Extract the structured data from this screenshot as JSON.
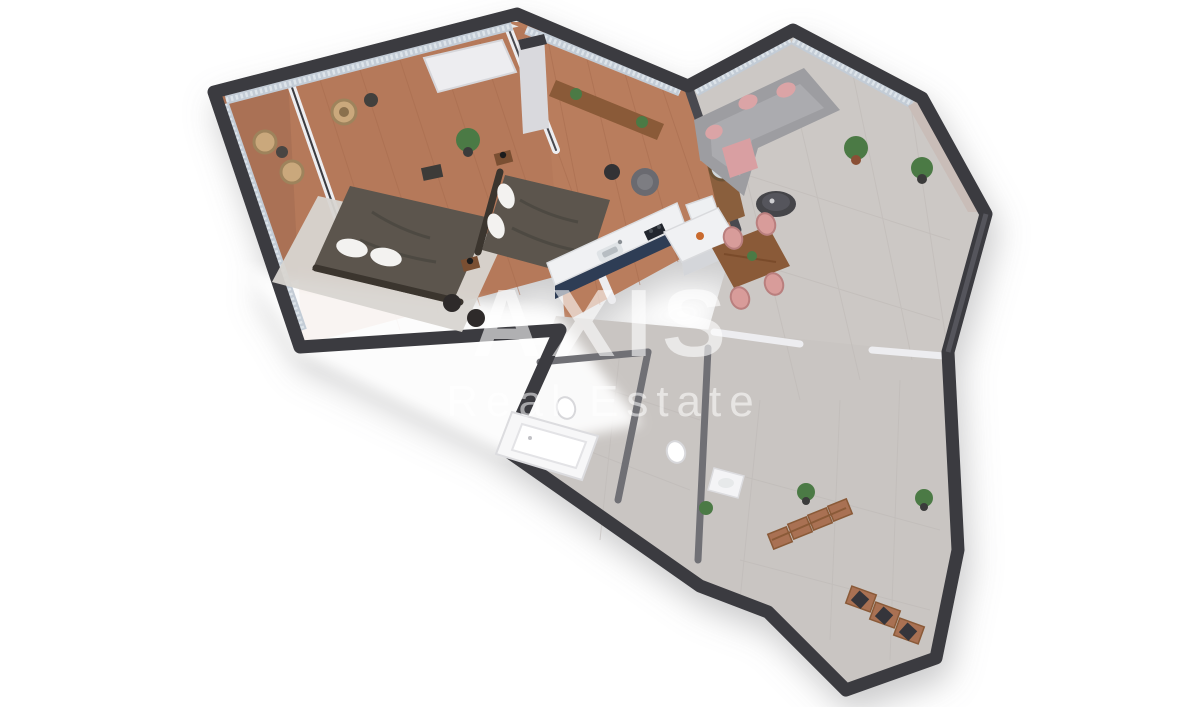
{
  "scene": {
    "type": "isometric-3d-floor-plan-render",
    "background": "#ffffff",
    "description": "3D cutaway floor plan of a two-bedroom apartment viewed from above at an angle"
  },
  "watermark": {
    "line1": "AXIS",
    "line2": "Real Estate",
    "color": "#ffffff"
  },
  "palette": {
    "wall_dark": "#3b3b40",
    "wall_mid": "#6f6f75",
    "wall_light": "#ededf0",
    "wood_floor": "#b5795a",
    "wood_floor_line": "#a76c4e",
    "tile_floor": "#ccc8c5",
    "tile_line": "#bfbab7",
    "blinds": "#c3ccd6",
    "blind_slat": "#dde4ea",
    "bedding_dark": "#5b554d",
    "rug": "#d8d5d1",
    "sofa_gray": "#9d9da1",
    "accent_pink": "#dba4a6",
    "kitchen_navy": "#2f3c54",
    "counter_white": "#f0f1f3",
    "wood_furniture": "#a97152",
    "wood_dark": "#8a5a38",
    "plant_green": "#4c7a45",
    "fixture_white": "#f7f7f8",
    "cushion_dark": "#35353a"
  },
  "rooms": [
    {
      "name": "balcony",
      "floor": "wood",
      "furniture": [
        "wicker-chair",
        "wicker-chair",
        "side-table"
      ]
    },
    {
      "name": "bedroom-1",
      "floor": "wood",
      "furniture": [
        "double-bed",
        "rug",
        "headboard",
        "stool",
        "stool",
        "rattan-chair",
        "side-table",
        "wardrobe",
        "dresser"
      ]
    },
    {
      "name": "bedroom-2",
      "floor": "wood",
      "furniture": [
        "double-bed",
        "nightstand",
        "nightstand",
        "window-bench",
        "barrel-chair",
        "side-table",
        "plant",
        "white-column"
      ]
    },
    {
      "name": "kitchen",
      "floor": "tile",
      "furniture": [
        "navy-counter",
        "sink",
        "cooktop",
        "tall-cabinet"
      ]
    },
    {
      "name": "living-dining",
      "floor": "tile",
      "furniture": [
        "corner-sofa",
        "pink-pillows",
        "pink-throw",
        "coffee-table",
        "media-partition-round-mirror",
        "kitchen-island",
        "dining-table",
        "dining-chairs-x4",
        "plant",
        "corner-plant"
      ]
    },
    {
      "name": "bathroom",
      "floor": "tile",
      "furniture": [
        "bathtub",
        "toilet"
      ]
    },
    {
      "name": "wc",
      "floor": "tile",
      "furniture": [
        "toilet",
        "vanity-basin",
        "plant"
      ]
    },
    {
      "name": "entry-hall",
      "floor": "tile",
      "furniture": [
        "wardrobe-modules",
        "plant",
        "plant"
      ]
    },
    {
      "name": "entry-niche",
      "floor": "tile",
      "furniture": [
        "bench-cushion",
        "bench-cushion",
        "bench-cushion"
      ]
    }
  ]
}
